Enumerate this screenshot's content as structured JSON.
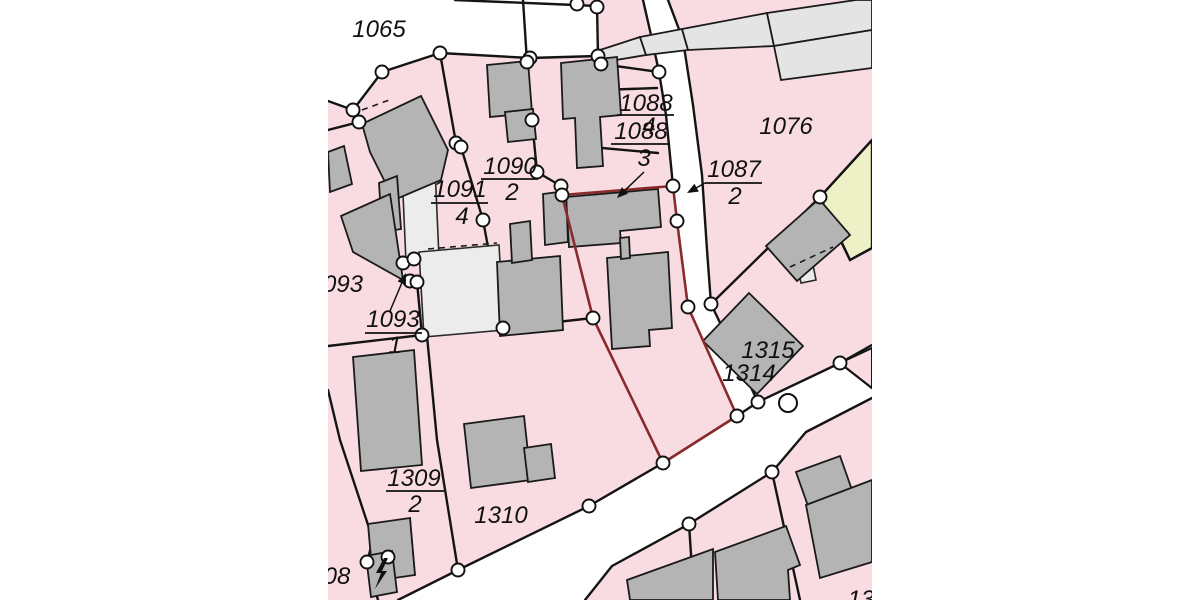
{
  "map": {
    "type": "cadastral-parcel-map",
    "colors": {
      "page_bg": "#ffffff",
      "parcel_pink": "#f9dce1",
      "road_white": "#ffffff",
      "building_gray": "#b4b4b4",
      "building_light": "#e4e4e4",
      "courtyard_light": "#ececec",
      "parcel_yellow": "#eef0c6",
      "boundary_black": "#141414",
      "selected_red": "#8a2b2b",
      "vertex_fill": "#ffffff"
    },
    "clip": [
      328,
      0,
      544,
      600
    ],
    "roads": [
      [
        328,
        0,
        578,
        0,
        576,
        4,
        597,
        6,
        598,
        56,
        530,
        58,
        440,
        53,
        382,
        72,
        353,
        110,
        328,
        101
      ],
      [
        643,
        0,
        668,
        0,
        683,
        40,
        693,
        105,
        702,
        175,
        707,
        250,
        711,
        304,
        758,
        402,
        737,
        416,
        688,
        307,
        677,
        221,
        673,
        186,
        666,
        115,
        659,
        72,
        651,
        35
      ],
      [
        758,
        402,
        840,
        363,
        872,
        345,
        872,
        398,
        806,
        432,
        772,
        472,
        689,
        524,
        612,
        566,
        585,
        600,
        398,
        600,
        458,
        570,
        589,
        506,
        663,
        463,
        737,
        416
      ]
    ],
    "pink_patches": [
      [
        840,
        363,
        872,
        348,
        872,
        388
      ],
      [
        834,
        535,
        866,
        523,
        872,
        556,
        842,
        568
      ]
    ],
    "yellow_parcel": [
      820,
      197,
      872,
      140,
      872,
      248,
      850,
      260
    ],
    "courtyards": [
      [
        402,
        172,
        435,
        168,
        439,
        258,
        406,
        262
      ],
      [
        419,
        252,
        499,
        245,
        504,
        330,
        424,
        337
      ],
      [
        798,
        268,
        813,
        265,
        816,
        280,
        801,
        283
      ]
    ],
    "light_buildings": [
      [
        600,
        50,
        640,
        37,
        646,
        55,
        604,
        62
      ],
      [
        640,
        37,
        682,
        29,
        688,
        50,
        646,
        55
      ],
      [
        682,
        29,
        767,
        13,
        774,
        46,
        688,
        50
      ],
      [
        767,
        13,
        856,
        0,
        872,
        0,
        872,
        30,
        774,
        46
      ],
      [
        774,
        46,
        872,
        30,
        872,
        68,
        781,
        80
      ]
    ],
    "buildings": [
      [
        362,
        124,
        421,
        96,
        448,
        150,
        441,
        180,
        394,
        200,
        370,
        152
      ],
      [
        328,
        152,
        344,
        146,
        352,
        184,
        330,
        192
      ],
      [
        379,
        183,
        397,
        176,
        401,
        229,
        382,
        232
      ],
      [
        341,
        216,
        390,
        194,
        403,
        280,
        353,
        252
      ],
      [
        487,
        65,
        528,
        61,
        532,
        113,
        490,
        117
      ],
      [
        505,
        112,
        533,
        109,
        536,
        139,
        508,
        142
      ],
      [
        561,
        63,
        617,
        57,
        621,
        115,
        600,
        117,
        603,
        166,
        577,
        168,
        575,
        118,
        563,
        119
      ],
      [
        566,
        197,
        658,
        189,
        661,
        227,
        620,
        231,
        621,
        243,
        569,
        247
      ],
      [
        607,
        258,
        668,
        252,
        672,
        328,
        649,
        330,
        650,
        346,
        612,
        349
      ],
      [
        620,
        238,
        629,
        237,
        630,
        258,
        621,
        259
      ],
      [
        497,
        262,
        560,
        256,
        563,
        330,
        500,
        336
      ],
      [
        510,
        224,
        530,
        221,
        532,
        260,
        512,
        263
      ],
      [
        543,
        194,
        566,
        191,
        568,
        242,
        545,
        245
      ],
      [
        819,
        199,
        766,
        246,
        797,
        281,
        850,
        235
      ],
      [
        749,
        293,
        703,
        341,
        757,
        394,
        803,
        346
      ],
      [
        353,
        357,
        414,
        350,
        422,
        465,
        361,
        471
      ],
      [
        368,
        524,
        410,
        518,
        415,
        575,
        373,
        581
      ],
      [
        366,
        556,
        392,
        551,
        397,
        592,
        371,
        597
      ],
      [
        464,
        424,
        524,
        416,
        531,
        480,
        471,
        488
      ],
      [
        524,
        448,
        551,
        444,
        555,
        478,
        528,
        482
      ],
      [
        627,
        580,
        713,
        549,
        713,
        600,
        630,
        600
      ],
      [
        715,
        552,
        786,
        526,
        800,
        565,
        788,
        570,
        790,
        600,
        718,
        600
      ],
      [
        796,
        472,
        840,
        456,
        852,
        490,
        808,
        506
      ],
      [
        806,
        505,
        872,
        480,
        872,
        562,
        820,
        578
      ]
    ],
    "boundaries": [
      [
        455,
        0,
        575,
        5,
        597,
        6
      ],
      [
        597,
        6,
        598,
        56
      ],
      [
        328,
        101,
        353,
        110,
        382,
        72,
        440,
        53,
        530,
        58,
        598,
        56
      ],
      [
        598,
        56,
        601,
        64,
        659,
        72
      ],
      [
        643,
        0,
        651,
        35,
        659,
        72,
        666,
        115,
        673,
        186
      ],
      [
        668,
        0,
        683,
        40,
        693,
        105,
        702,
        175,
        707,
        250,
        711,
        304
      ],
      [
        711,
        304,
        758,
        402
      ],
      [
        758,
        402,
        840,
        363
      ],
      [
        840,
        363,
        872,
        345
      ],
      [
        840,
        363,
        872,
        388
      ],
      [
        758,
        402,
        737,
        416,
        663,
        463,
        589,
        506,
        458,
        570,
        398,
        600
      ],
      [
        872,
        398,
        806,
        432,
        772,
        472,
        689,
        524,
        612,
        566,
        585,
        600
      ],
      [
        440,
        53,
        456,
        143,
        461,
        147,
        483,
        220,
        503,
        328
      ],
      [
        328,
        346,
        422,
        335,
        503,
        328,
        593,
        318
      ],
      [
        417,
        282,
        422,
        335
      ],
      [
        353,
        110,
        359,
        122,
        328,
        130
      ],
      [
        427,
        336,
        437,
        440,
        458,
        570
      ],
      [
        328,
        390,
        340,
        440,
        373,
        540,
        367,
        562,
        378,
        600
      ],
      [
        711,
        304,
        820,
        197
      ],
      [
        820,
        197,
        872,
        140
      ],
      [
        820,
        197,
        850,
        260,
        872,
        248
      ],
      [
        772,
        472,
        800,
        600
      ],
      [
        689,
        524,
        694,
        600
      ],
      [
        537,
        172,
        561,
        186,
        562,
        195
      ],
      [
        523,
        0,
        527,
        62,
        532,
        120,
        537,
        172
      ],
      [
        580,
        146,
        658,
        153
      ],
      [
        600,
        90,
        657,
        88
      ]
    ],
    "dashed_lines": [
      [
        362,
        110,
        392,
        99
      ],
      [
        428,
        249,
        497,
        243
      ],
      [
        790,
        267,
        833,
        247
      ],
      [
        410,
        518,
        415,
        575
      ],
      [
        398,
        268,
        412,
        262
      ]
    ],
    "selected_parcel": {
      "points": [
        562,
        195,
        673,
        186,
        677,
        221,
        688,
        307,
        737,
        416,
        663,
        463,
        593,
        318
      ],
      "outline_color": "#8a2b2b"
    },
    "vertices": [
      [
        577,
        4
      ],
      [
        597,
        7
      ],
      [
        353,
        110
      ],
      [
        359,
        122
      ],
      [
        382,
        72
      ],
      [
        440,
        53
      ],
      [
        530,
        58
      ],
      [
        598,
        56
      ],
      [
        601,
        64
      ],
      [
        456,
        143
      ],
      [
        461,
        147
      ],
      [
        483,
        220
      ],
      [
        503,
        328
      ],
      [
        422,
        335
      ],
      [
        527,
        62
      ],
      [
        532,
        120
      ],
      [
        537,
        172
      ],
      [
        561,
        186
      ],
      [
        562,
        195
      ],
      [
        659,
        72
      ],
      [
        673,
        186
      ],
      [
        677,
        221
      ],
      [
        688,
        307
      ],
      [
        711,
        304
      ],
      [
        593,
        318
      ],
      [
        403,
        263
      ],
      [
        414,
        259
      ],
      [
        410,
        281
      ],
      [
        417,
        282
      ],
      [
        737,
        416
      ],
      [
        758,
        402
      ],
      [
        663,
        463
      ],
      [
        589,
        506
      ],
      [
        458,
        570
      ],
      [
        689,
        524
      ],
      [
        772,
        472
      ],
      [
        840,
        363
      ],
      [
        820,
        197
      ],
      [
        367,
        562
      ],
      [
        388,
        557
      ]
    ],
    "large_circle": {
      "x": 788,
      "y": 403,
      "r": 9
    },
    "labels": [
      {
        "text": "1065",
        "x": 379,
        "y": 37
      },
      {
        "text": "1088",
        "x": 646,
        "y": 111
      },
      {
        "text": "4",
        "x": 649,
        "y": 134
      },
      {
        "text": "1088",
        "x": 641,
        "y": 139
      },
      {
        "text": "3",
        "x": 644,
        "y": 166
      },
      {
        "text": "1076",
        "x": 786,
        "y": 134
      },
      {
        "text": "1087",
        "x": 734,
        "y": 177
      },
      {
        "text": "2",
        "x": 735,
        "y": 204
      },
      {
        "text": "1090",
        "x": 510,
        "y": 174
      },
      {
        "text": "2",
        "x": 512,
        "y": 200
      },
      {
        "text": "1091",
        "x": 460,
        "y": 197
      },
      {
        "text": "4",
        "x": 462,
        "y": 224
      },
      {
        "text": "093",
        "x": 343,
        "y": 292
      },
      {
        "text": "1093",
        "x": 393,
        "y": 327
      },
      {
        "text": "1",
        "x": 395,
        "y": 353
      },
      {
        "text": "1315",
        "x": 768,
        "y": 358
      },
      {
        "text": "1314",
        "x": 749,
        "y": 381
      },
      {
        "text": "1309",
        "x": 414,
        "y": 486
      },
      {
        "text": "2",
        "x": 415,
        "y": 512
      },
      {
        "text": "1310",
        "x": 501,
        "y": 523
      },
      {
        "text": "08",
        "x": 337,
        "y": 584
      },
      {
        "text": "13",
        "x": 861,
        "y": 607
      }
    ],
    "fraction_lines": [
      [
        617,
        115,
        674,
        115
      ],
      [
        611,
        144,
        669,
        144
      ],
      [
        705,
        183,
        762,
        183
      ],
      [
        481,
        179,
        538,
        179
      ],
      [
        431,
        203,
        488,
        203
      ],
      [
        365,
        333,
        422,
        333
      ],
      [
        386,
        491,
        444,
        491
      ]
    ],
    "arrows": [
      {
        "from": [
          644,
          172
        ],
        "tip": [
          617,
          198
        ]
      },
      {
        "from": [
          705,
          183
        ],
        "tip": [
          687,
          193
        ]
      },
      {
        "from": [
          390,
          311
        ],
        "tip": [
          406,
          273
        ]
      }
    ],
    "lightning_bolt": [
      384,
      558,
      376,
      573,
      381,
      573,
      375,
      589,
      387,
      571,
      382,
      571,
      388,
      558
    ]
  }
}
